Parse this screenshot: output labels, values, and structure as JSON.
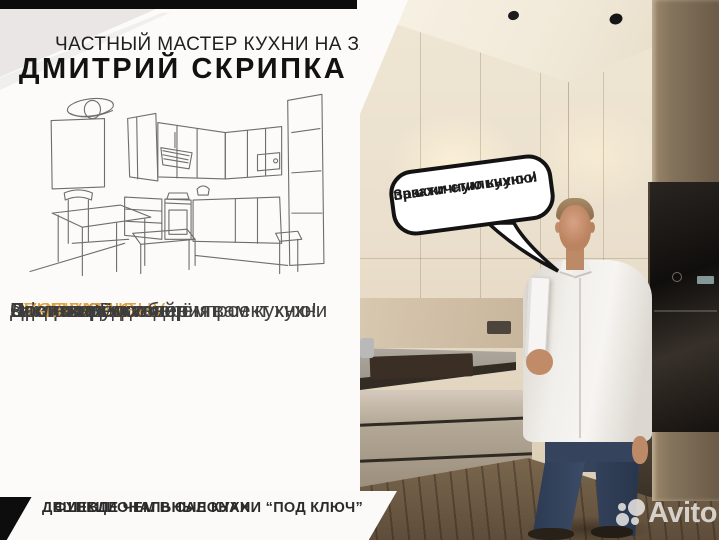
{
  "flyer": {
    "tagline": "ЧАСТНЫЙ МАСТЕР КУХНИ НА ЗАКАЗ",
    "name": "ДМИТРИЙ СКРИПКА",
    "services": [
      {
        "prefix": "",
        "highlight": "БЕСПЛАТНО",
        "suffix": " выезжаю на замер"
      },
      {
        "prefix": "Создам 3D дизайн - проект кухни",
        "highlight": "",
        "suffix": ""
      },
      {
        "prefix": "Сформирую ",
        "highlight": "ЛУЧШУЮ ЦЕНУ",
        "suffix": ""
      },
      {
        "prefix": "Заключим договор",
        "highlight": "",
        "suffix": ""
      },
      {
        "prefix": "Произведём изделия",
        "highlight": "",
        "suffix": ""
      },
      {
        "prefix": "Доставим и соберём вам кухню!",
        "highlight": "",
        "suffix": ""
      }
    ],
    "footer_line1": "ФУНКЦИОНАЛЬНЫЕ КУХНИ “ПОД КЛЮЧ”",
    "footer_line2": "ДЕШЕВЛЕ ЧЕМ В САЛОНАХ"
  },
  "photo": {
    "speech_bubble_line1": "Закажи стильную и",
    "speech_bubble_line2": "практичную кухню!"
  },
  "watermark": {
    "brand": "Avito"
  },
  "colors": {
    "accent_orange": "#DFA23C",
    "banner_black": "#0D0D0D",
    "body_text": "#3D3D3D"
  }
}
